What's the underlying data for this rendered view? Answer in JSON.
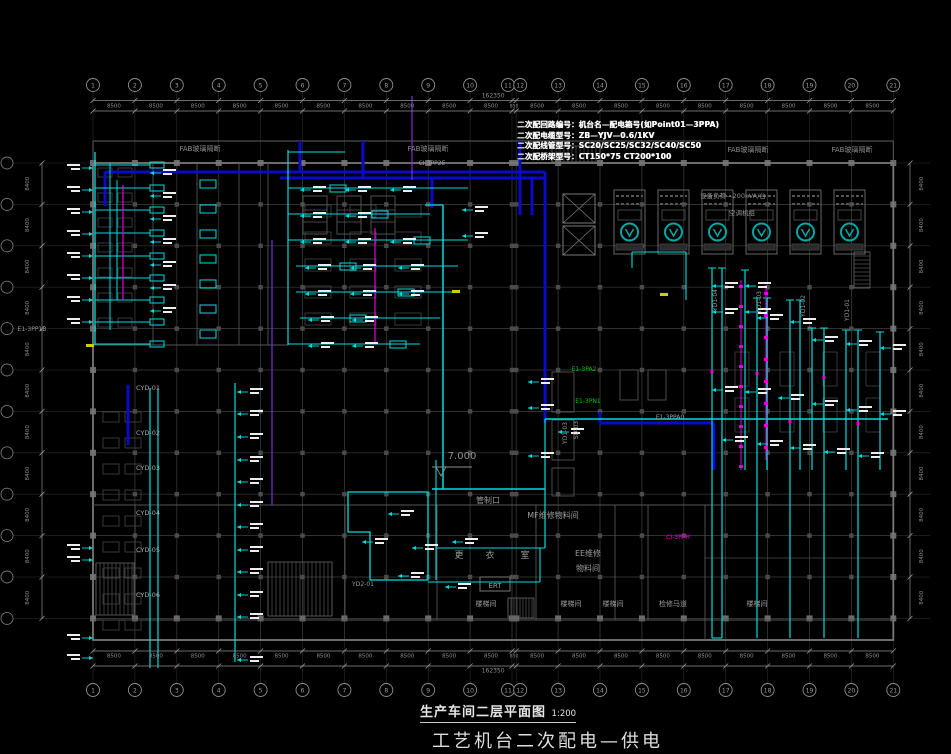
{
  "colors": {
    "background": "#000000",
    "grid": "#2c2c2c",
    "grid_inner": "#3a3a3a",
    "wall": "#787878",
    "wall_dim": "#565656",
    "gray_text": "#9c9c9c",
    "dim_text": "#8f8f8f",
    "white": "#ededed",
    "cyan": "#00dcdc",
    "teal": "#00a8a8",
    "navy": "#0a0ac8",
    "magenta": "#e000e0",
    "purple": "#7a2fd6",
    "green": "#00c800",
    "yellow": "#cfcf00"
  },
  "axes": {
    "top_bubbles": [
      "1",
      "2",
      "3",
      "4",
      "5",
      "6",
      "7",
      "8",
      "9",
      "10",
      "11",
      "12",
      "13",
      "14",
      "15",
      "16",
      "17",
      "18",
      "19",
      "20",
      "21"
    ],
    "bottom_bubbles": [
      "1",
      "2",
      "3",
      "4",
      "5",
      "6",
      "7",
      "8",
      "9",
      "10",
      "11",
      "12",
      "13",
      "14",
      "15",
      "16",
      "17",
      "18",
      "19",
      "20",
      "21"
    ],
    "bay_dims": [
      "8500",
      "8500",
      "8500",
      "8500",
      "8500",
      "8500",
      "8500",
      "8500",
      "8500",
      "8500",
      "850",
      "8500",
      "8500",
      "8500",
      "8500",
      "8500",
      "8500",
      "8500",
      "8500",
      "8500"
    ],
    "total_dim": "162350",
    "left_dims": [
      "8400",
      "8400",
      "8400",
      "8400",
      "8400",
      "8400",
      "8400",
      "8400",
      "8400",
      "8400",
      "8400"
    ],
    "right_dims": [
      "8400",
      "8400",
      "8400",
      "8400",
      "8400",
      "8400",
      "8400",
      "8400",
      "8400",
      "8400",
      "8400"
    ]
  },
  "labels": {
    "legend": [
      "二次配回路编号：机台名—配电箱号(如Point01—3PPA)",
      "二次配电缆型号：ZB—YJV—0.6/1KV",
      "二次配线管型号：SC20/SC25/SC32/SC40/SC50",
      "二次配桥架型号：CT150*75  CT200*100"
    ],
    "title": {
      "main": "生产车间二层平面图",
      "scale": "1:200",
      "sub": "工艺机台二次配电—供电"
    },
    "elevation": "7.000",
    "rooms": [
      {
        "t": "管制口",
        "x": 488,
        "y": 503,
        "s": 8
      },
      {
        "t": "MF维修物料间",
        "x": 553,
        "y": 518,
        "s": 8
      },
      {
        "t": "EE维修",
        "x": 588,
        "y": 556,
        "s": 8
      },
      {
        "t": "物料间",
        "x": 588,
        "y": 571,
        "s": 8
      },
      {
        "t": "更",
        "x": 459,
        "y": 558,
        "s": 9
      },
      {
        "t": "衣",
        "x": 490,
        "y": 558,
        "s": 9
      },
      {
        "t": "室",
        "x": 525,
        "y": 558,
        "s": 9
      },
      {
        "t": "ERT",
        "x": 495,
        "y": 588,
        "s": 7
      },
      {
        "t": "楼梯间",
        "x": 486,
        "y": 606,
        "s": 7
      },
      {
        "t": "楼梯间",
        "x": 571,
        "y": 606,
        "s": 7
      },
      {
        "t": "楼梯间",
        "x": 613,
        "y": 606,
        "s": 7
      },
      {
        "t": "检修马道",
        "x": 673,
        "y": 606,
        "s": 7
      },
      {
        "t": "楼梯间",
        "x": 757,
        "y": 606,
        "s": 7
      }
    ],
    "fab": [
      {
        "t": "FAB玻璃隔断",
        "x": 200,
        "y": 151
      },
      {
        "t": "FAB玻璃隔断",
        "x": 428,
        "y": 151
      },
      {
        "t": "FAB玻璃隔断",
        "x": 748,
        "y": 152
      },
      {
        "t": "FAB玻璃隔断",
        "x": 852,
        "y": 152
      }
    ],
    "notes": [
      {
        "t": "设备负荷—200kVA/台",
        "x": 733,
        "y": 198
      },
      {
        "t": "空调机组",
        "x": 742,
        "y": 215
      }
    ],
    "cyd": [
      {
        "t": "CYD-01",
        "y": 390
      },
      {
        "t": "CYD-02",
        "y": 435
      },
      {
        "t": "CYD-03",
        "y": 470
      },
      {
        "t": "CYD-04",
        "y": 515
      },
      {
        "t": "CYD-05",
        "y": 552
      },
      {
        "t": "CYD-06",
        "y": 597
      }
    ],
    "tags": [
      {
        "t": "CI-3PP2E",
        "x": 432,
        "y": 165,
        "c": "gray"
      },
      {
        "t": "E1-3PA2",
        "x": 584,
        "y": 371,
        "c": "green"
      },
      {
        "t": "E1-3PN1",
        "x": 588,
        "y": 403,
        "c": "green"
      },
      {
        "t": "E1-3PPA0",
        "x": 670,
        "y": 419,
        "c": "gray"
      },
      {
        "t": "CI-3PPH",
        "x": 678,
        "y": 539,
        "c": "magenta"
      },
      {
        "t": "YD2-01",
        "x": 363,
        "y": 586,
        "c": "gray"
      },
      {
        "t": "E1-3PP1B",
        "x": 32,
        "y": 331,
        "c": "gray"
      },
      {
        "t": "YD1-04",
        "x": 717,
        "y": 300,
        "c": "gray",
        "r": -90
      },
      {
        "t": "YD1-03",
        "x": 761,
        "y": 302,
        "c": "gray",
        "r": -90
      },
      {
        "t": "YD1-02",
        "x": 805,
        "y": 306,
        "c": "gray",
        "r": -90
      },
      {
        "t": "YD1-01",
        "x": 849,
        "y": 310,
        "c": "gray",
        "r": -90
      },
      {
        "t": "YD1-03",
        "x": 567,
        "y": 433,
        "c": "gray",
        "r": -90
      },
      {
        "t": "SD-03",
        "x": 578,
        "y": 430,
        "c": "gray",
        "r": -90
      }
    ]
  }
}
